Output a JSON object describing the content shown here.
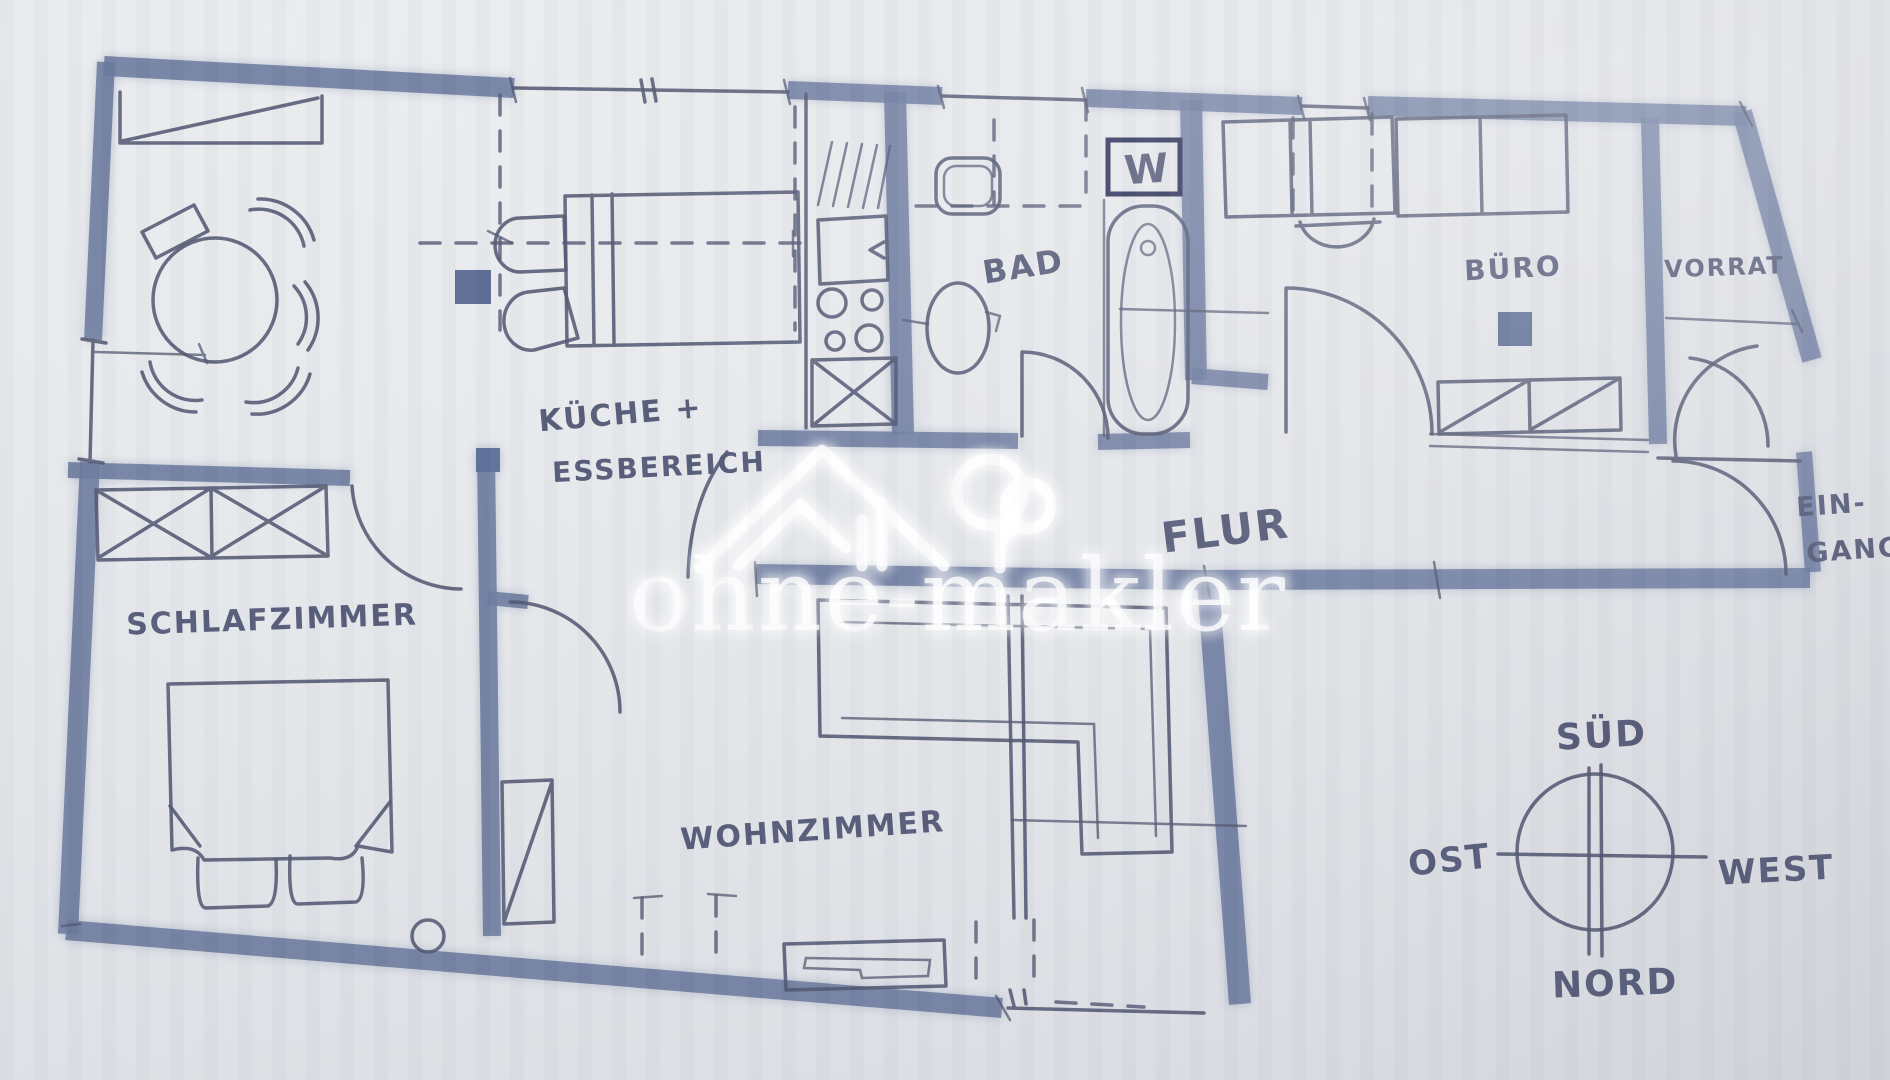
{
  "document": {
    "kind": "hand-drawn apartment floor plan sketch"
  },
  "watermark": {
    "brand": "ohne-makler",
    "logo": "house-and-tree"
  },
  "rooms": {
    "kitchen_line1": "KÜCHE +",
    "kitchen_line2": "ESSBEREICH",
    "bath": "BAD",
    "hallway": "FLUR",
    "office": "BÜRO",
    "storage": "VORRAT",
    "entrance_line1": "EIN-",
    "entrance_line2": "GANG",
    "bedroom": "SCHLAFZIMMER",
    "living_room": "WOHNZIMMER"
  },
  "appliances": {
    "washer": "W"
  },
  "compass": {
    "south": "SÜD",
    "east": "OST",
    "west": "WEST",
    "north": "NORD"
  },
  "colors": {
    "paper": "#e6e8eb",
    "marker_wall": "#6b7a9e",
    "pen": "#50556f",
    "label": "#565b78",
    "washer_box": "#2d3158",
    "watermark": "#ffffff"
  }
}
